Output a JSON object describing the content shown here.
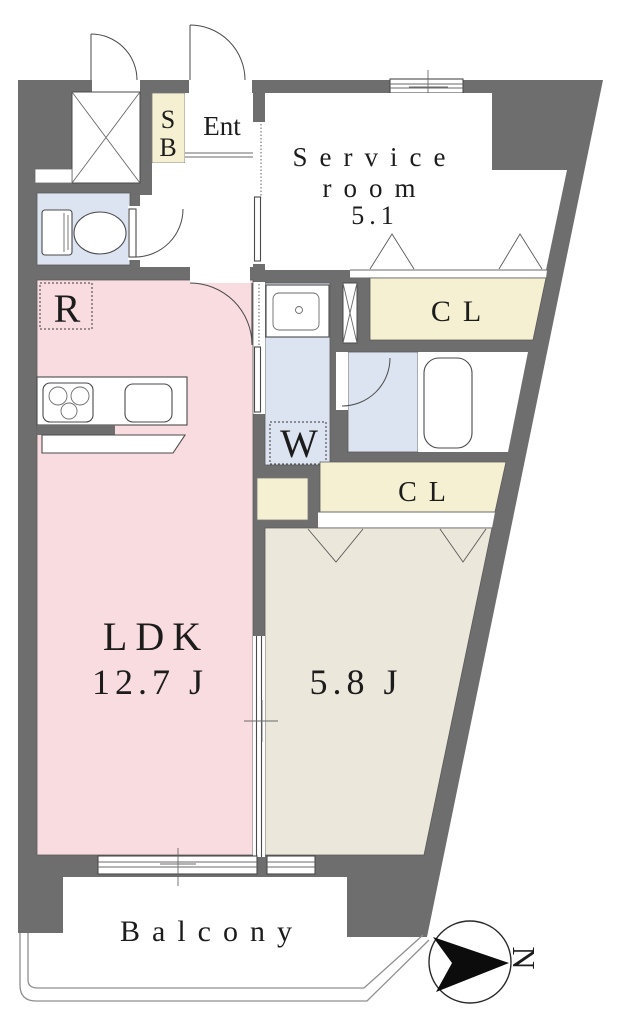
{
  "labels": {
    "shoe_box": {
      "line1": "S",
      "line2": "B"
    },
    "entrance": "Ent",
    "service_room": {
      "line1": "Service",
      "line2": "room",
      "area": "5.1"
    },
    "closet_upper": "CL",
    "closet_lower": "CL",
    "refrigerator_space": "R",
    "washer_space": "W",
    "ldk": {
      "name": "LDK",
      "area": "12.7 J"
    },
    "western_room": {
      "area": "5.8 J"
    },
    "balcony": "Balcony",
    "compass": {
      "north": "N"
    }
  },
  "colors": {
    "wall": "#6e6e6e",
    "ldk_pink": "#f9dce0",
    "room_beige": "#ebe7da",
    "closet_cream": "#f5f0d2",
    "wet_blue": "#dce3f1",
    "white": "#ffffff"
  }
}
